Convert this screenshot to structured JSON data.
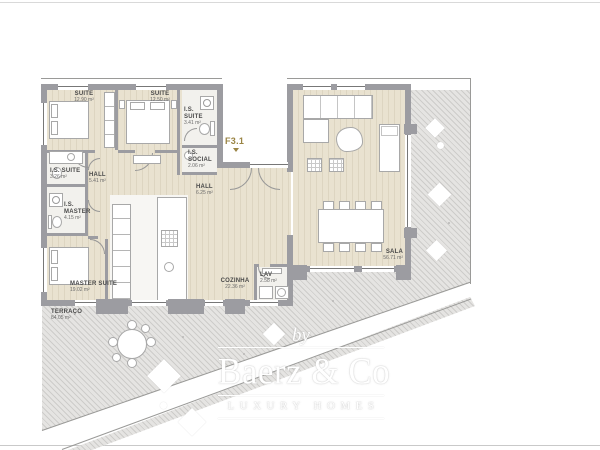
{
  "plan": {
    "unit_label": "F3.1",
    "rooms": [
      {
        "id": "suite1",
        "name": "SUITE",
        "area": "12.90 m²"
      },
      {
        "id": "suite2",
        "name": "SUITE",
        "area": "12.50 m²"
      },
      {
        "id": "is-suite-east",
        "name": "I.S. SUITE",
        "area": "3.41 m²"
      },
      {
        "id": "is-social",
        "name": "I.S. SOCIAL",
        "area": "2.06 m²"
      },
      {
        "id": "is-suite-west",
        "name": "I.S. SUITE",
        "area": "3.26 m²"
      },
      {
        "id": "hall-west",
        "name": "HALL",
        "area": "5.41 m²"
      },
      {
        "id": "hall-east",
        "name": "HALL",
        "area": "6.25 m²"
      },
      {
        "id": "is-master",
        "name": "I.S. MASTER",
        "area": "4.15 m²"
      },
      {
        "id": "master-suite",
        "name": "MASTER SUITE",
        "area": "19.02 m²"
      },
      {
        "id": "cozinha",
        "name": "COZINHA",
        "area": "22.36 m²"
      },
      {
        "id": "lav",
        "name": "LAV",
        "area": "2.58 m²"
      },
      {
        "id": "sala",
        "name": "SALA",
        "area": "56.71 m²"
      },
      {
        "id": "terraco",
        "name": "TERRAÇO",
        "area": "84.05 m²"
      }
    ]
  },
  "watermark": {
    "by": "by",
    "brand": "Baerz & Co",
    "tagline": "LUXURY HOMES"
  },
  "colors": {
    "wall": "#9c9ca1",
    "wood_floor": "#e9e2d0",
    "terrace": "#e5e4e2",
    "unit_label_accent": "#9a8444",
    "watermark": "#ffffff"
  }
}
